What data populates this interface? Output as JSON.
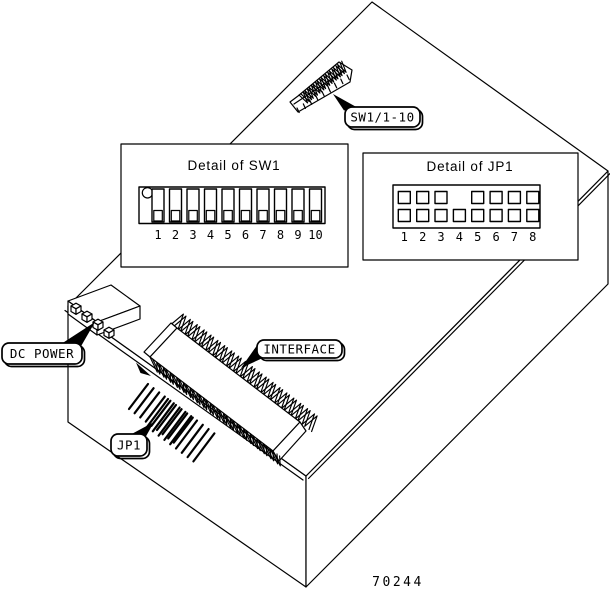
{
  "figure_number": "70244",
  "callouts": {
    "sw1": {
      "label": "SW1/1-10"
    },
    "dc_power": {
      "label": "DC POWER"
    },
    "interface": {
      "label": "INTERFACE"
    },
    "jp1": {
      "label": "JP1"
    }
  },
  "detail_sw1": {
    "title": "Detail of SW1",
    "positions": [
      "1",
      "2",
      "3",
      "4",
      "5",
      "6",
      "7",
      "8",
      "9",
      "10"
    ],
    "switch_state": "all levers down"
  },
  "detail_jp1": {
    "title": "Detail of JP1",
    "positions": [
      "1",
      "2",
      "3",
      "4",
      "5",
      "6",
      "7",
      "8"
    ],
    "top_row_pads": [
      1,
      2,
      3,
      5,
      6,
      7,
      8
    ],
    "bottom_row_pads": [
      1,
      2,
      3,
      4,
      5,
      6,
      7,
      8
    ]
  },
  "colors": {
    "line": "#000000",
    "background": "#ffffff"
  }
}
